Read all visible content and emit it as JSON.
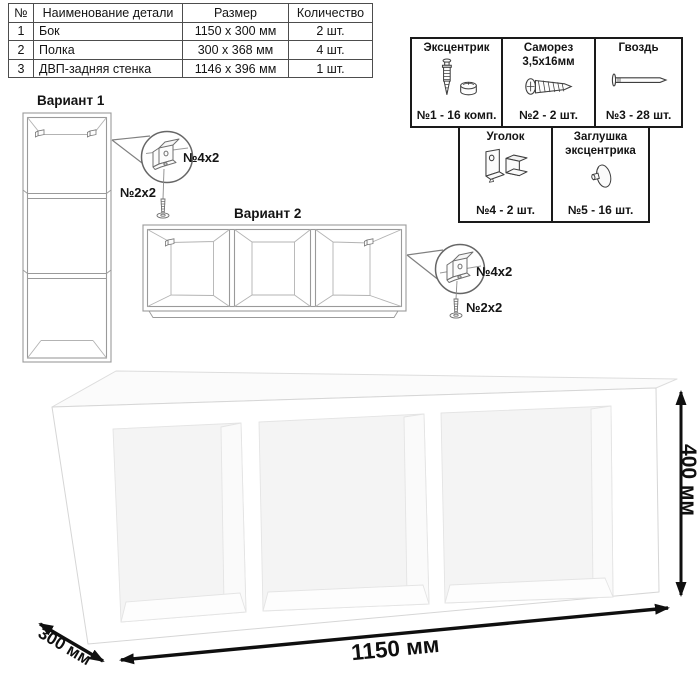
{
  "parts_table": {
    "headers": {
      "num": "№",
      "name": "Наименование детали",
      "size": "Размер",
      "qty": "Количество"
    },
    "rows": [
      {
        "num": "1",
        "name": "Бок",
        "size": "1150 x 300 мм",
        "qty": "2 шт."
      },
      {
        "num": "2",
        "name": "Полка",
        "size": "300 x 368 мм",
        "qty": "4 шт."
      },
      {
        "num": "3",
        "name": "ДВП-задняя стенка",
        "size": "1146 x 396 мм",
        "qty": "1 шт."
      }
    ]
  },
  "hardware_legend": {
    "items": [
      {
        "name": "Эксцентрик",
        "qty": "№1 - 16 комп.",
        "icon": "eccentric-cam-icon"
      },
      {
        "name": "Саморез 3,5х16мм",
        "qty": "№2 - 2 шт.",
        "icon": "screw-icon"
      },
      {
        "name": "Гвоздь",
        "qty": "№3 - 28 шт.",
        "icon": "nail-icon"
      },
      {
        "name": "Уголок",
        "qty": "№4 - 2 шт.",
        "icon": "corner-bracket-icon"
      },
      {
        "name": "Заглушка эксцентрика",
        "qty": "№5 - 16 шт.",
        "icon": "eccentric-cap-icon"
      }
    ]
  },
  "variants": {
    "variant1": {
      "title": "Вариант 1",
      "bracket_label": "№4x2",
      "screw_label": "№2x2"
    },
    "variant2": {
      "title": "Вариант 2",
      "bracket_label": "№4x2",
      "screw_label": "№2x2"
    }
  },
  "dimensions": {
    "width_label": "1150 мм",
    "depth_label": "300 мм",
    "height_label": "400 мм"
  },
  "colors": {
    "dimension": "#0f0f0f",
    "table_border": "#4d4d4d",
    "legend_border": "#1a1a1a",
    "drawing_outline": "#9a9a9a"
  }
}
